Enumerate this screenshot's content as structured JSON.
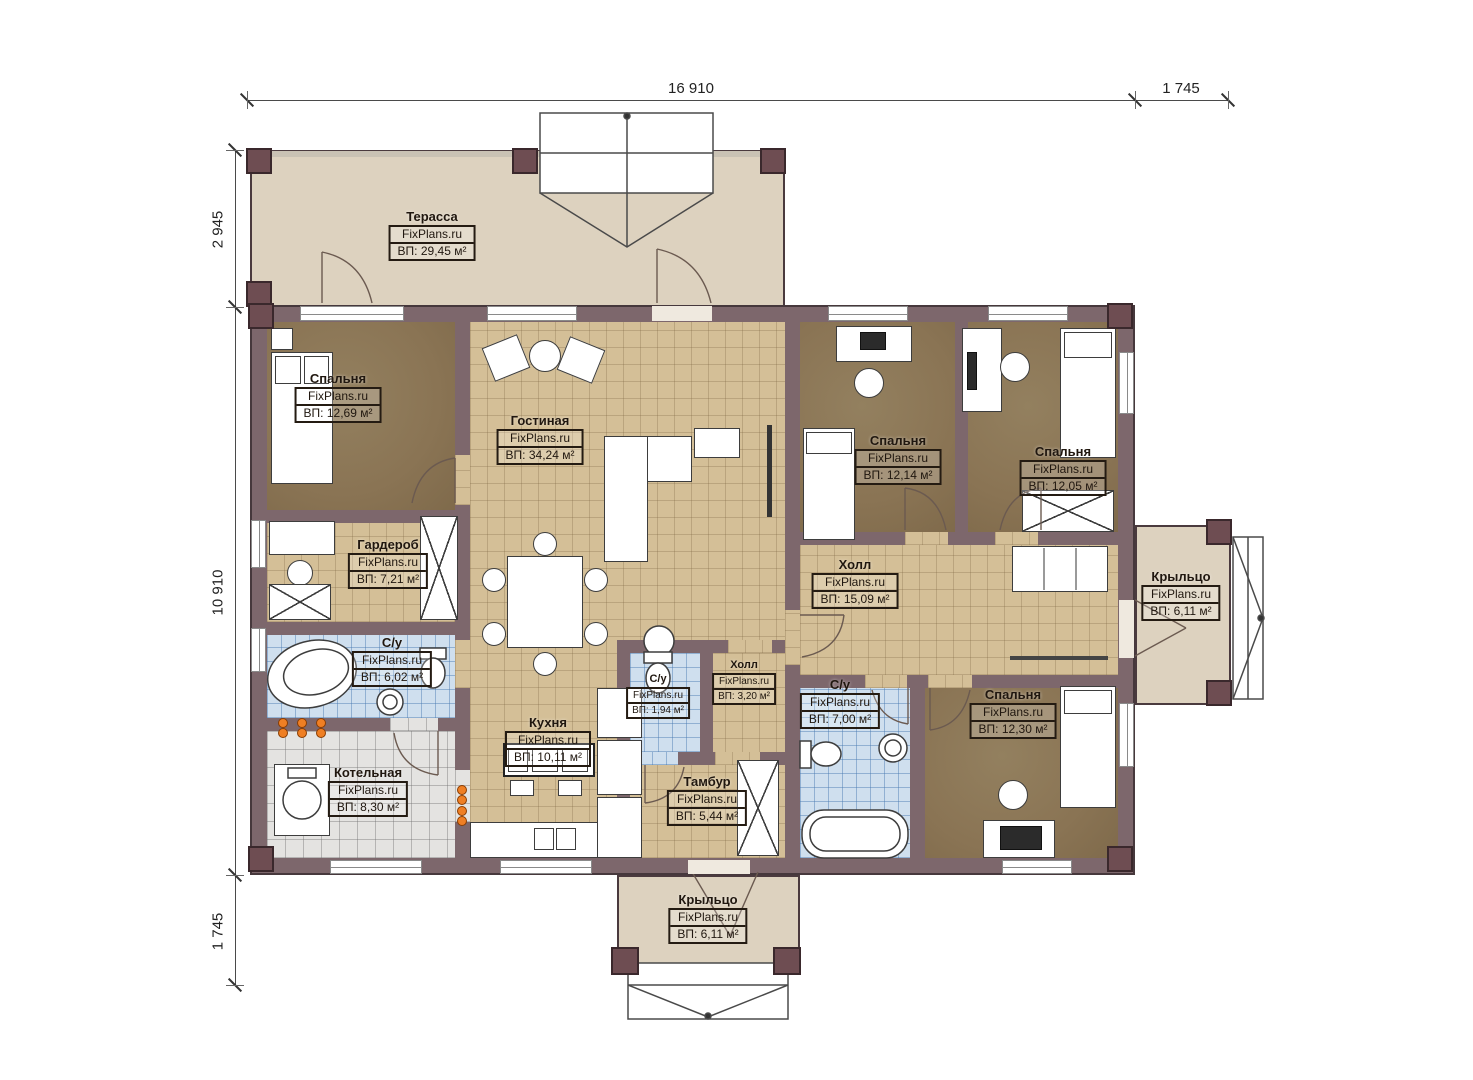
{
  "brand": "FixPlans.ru",
  "dimensions": {
    "top": [
      "16 910",
      "1 745"
    ],
    "left": [
      "2 945",
      "10 910",
      "1 745"
    ]
  },
  "rooms": [
    {
      "id": "terrace",
      "name": "Терасса",
      "area": "ВП: 29,45 м²"
    },
    {
      "id": "bedroom-1",
      "name": "Спальня",
      "area": "ВП: 12,69 м²"
    },
    {
      "id": "living-room",
      "name": "Гостиная",
      "area": "ВП: 34,24 м²"
    },
    {
      "id": "wardrobe",
      "name": "Гардероб",
      "area": "ВП: 7,21 м²"
    },
    {
      "id": "bathroom-1",
      "name": "С/у",
      "area": "ВП: 6,02 м²"
    },
    {
      "id": "boiler-room",
      "name": "Котельная",
      "area": "ВП: 8,30 м²"
    },
    {
      "id": "kitchen",
      "name": "Кухня",
      "area": "ВП: 10,11 м²"
    },
    {
      "id": "bathroom-2",
      "name": "С/у",
      "area": "ВП: 1,94 м²"
    },
    {
      "id": "hall-small",
      "name": "Холл",
      "area": "ВП: 3,20 м²"
    },
    {
      "id": "tambour",
      "name": "Тамбур",
      "area": "ВП: 5,44 м²"
    },
    {
      "id": "hall",
      "name": "Холл",
      "area": "ВП: 15,09 м²"
    },
    {
      "id": "bedroom-2",
      "name": "Спальня",
      "area": "ВП: 12,14 м²"
    },
    {
      "id": "bedroom-3",
      "name": "Спальня",
      "area": "ВП: 12,05 м²"
    },
    {
      "id": "bathroom-3",
      "name": "С/у",
      "area": "ВП: 7,00 м²"
    },
    {
      "id": "bedroom-4",
      "name": "Спальня",
      "area": "ВП: 12,30 м²"
    },
    {
      "id": "porch-right",
      "name": "Крыльцо",
      "area": "ВП: 6,11 м²"
    },
    {
      "id": "porch-bottom",
      "name": "Крыльцо",
      "area": "ВП: 6,11 м²"
    }
  ],
  "colors": {
    "wall": "#7d676c",
    "floor_wood": "#d4bf97",
    "floor_bedroom": "#8a7454",
    "floor_tile_blue": "#cfdfee",
    "floor_tile_gray": "#e4e3e1",
    "terrace": "#ddd2bf",
    "radiator": "#ef7f24"
  }
}
